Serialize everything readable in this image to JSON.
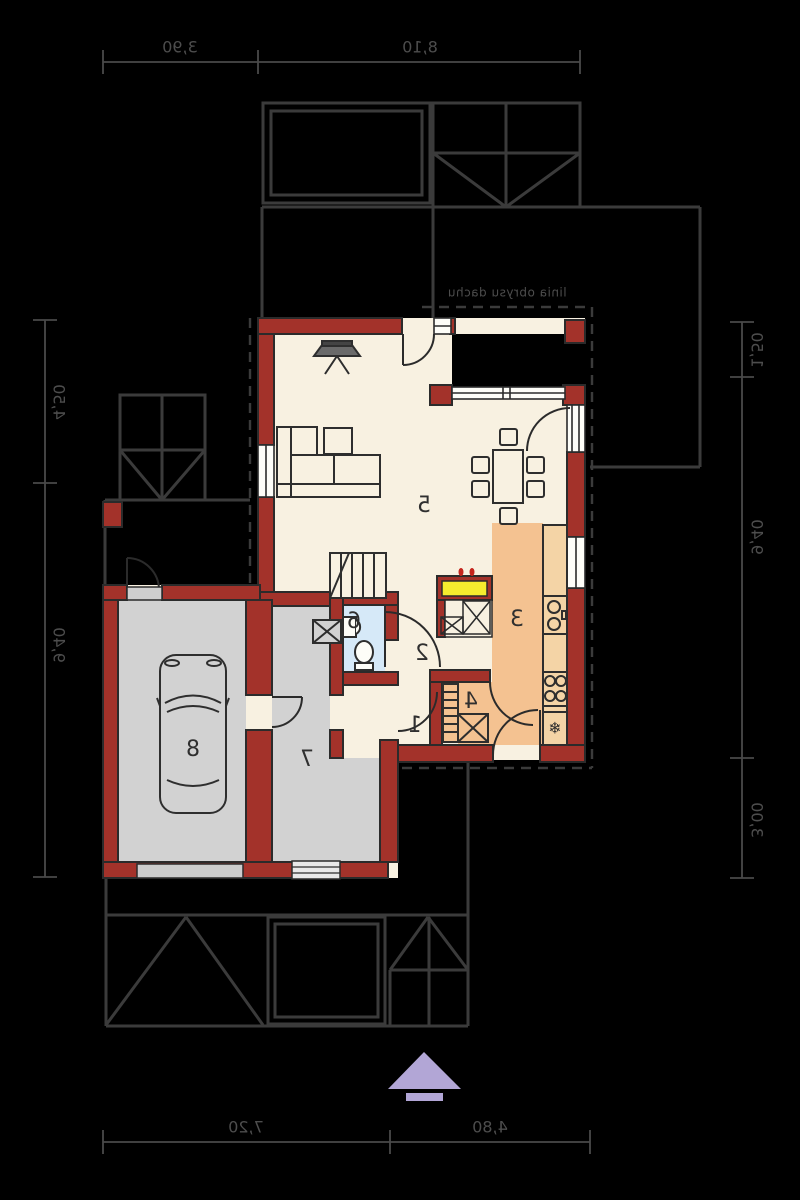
{
  "plan": {
    "roof_note": "linia obrysu dachu",
    "dimensions": {
      "top": [
        "3,90",
        "8,10"
      ],
      "bottom": [
        "7,20",
        "4,80"
      ],
      "left": [
        "4,50",
        "9,40"
      ],
      "right": [
        "1,50",
        "9,40",
        "3,00"
      ]
    },
    "rooms": {
      "r1": "1",
      "r2": "2",
      "r3": "3",
      "r4": "4",
      "r5": "5",
      "r6": "6",
      "r7": "7",
      "r8": "8"
    },
    "fridge_icon": "❄",
    "colors": {
      "background": "#000000",
      "wall": "#A3322A",
      "floor": "#F8F1E1",
      "kitchen_floor": "#F4C291",
      "counter": "#F4D4A6",
      "bathroom_floor": "#D6E9F8",
      "garage_floor": "#D2D2D2",
      "hob_yellow": "#F5EC2E",
      "north_arrow": "#B2A6D6",
      "outline": "#2E2E2E",
      "roof_line": "#3B3B3B",
      "dimension_line": "#4D4D4D"
    }
  }
}
